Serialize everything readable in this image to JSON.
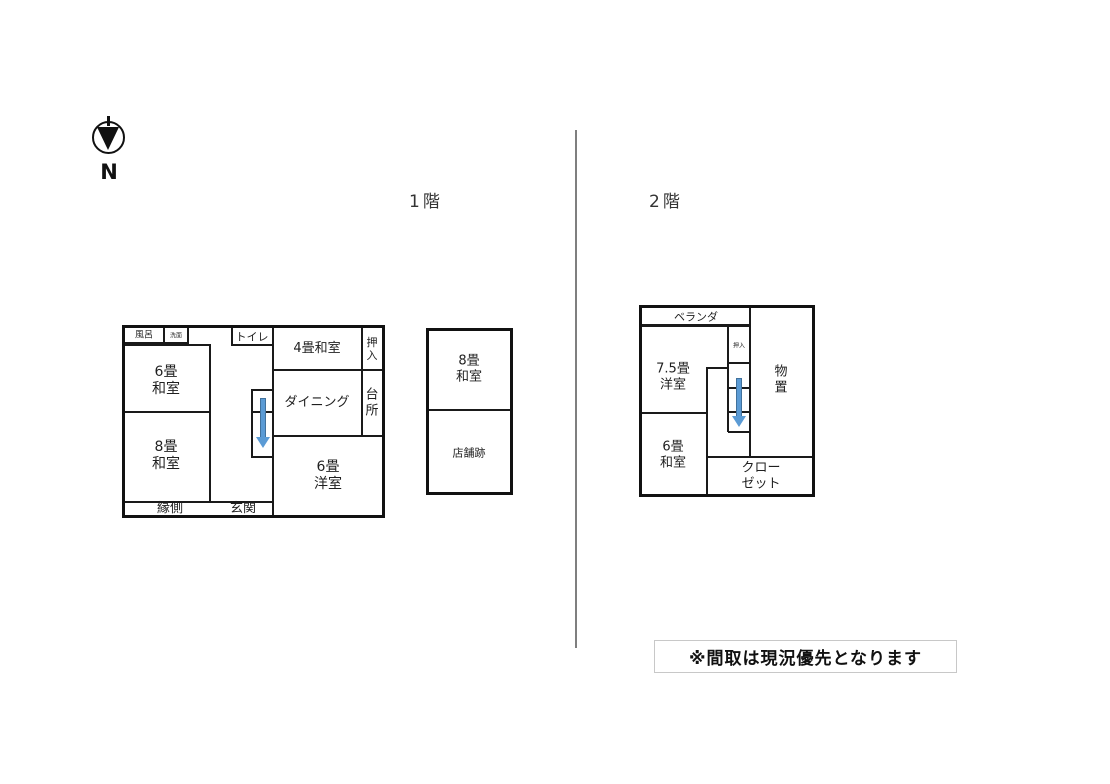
{
  "compass": {
    "label": "N"
  },
  "floors": {
    "floor1": {
      "title": "1階",
      "rooms": {
        "bath": "風呂",
        "washroom": "洗面",
        "toilet": "トイレ",
        "tatami4": "4畳和室",
        "oshiire": "押\n入",
        "tatami6": "6畳\n和室",
        "dining": "ダイニング",
        "kitchen": "台\n所",
        "tatami8": "8畳\n和室",
        "western6": "6畳\n洋室",
        "engawa": "縁側",
        "genkan": "玄関"
      }
    },
    "annex": {
      "rooms": {
        "tatami8": "8畳\n和室",
        "shop": "店舗跡"
      }
    },
    "floor2": {
      "title": "2階",
      "rooms": {
        "veranda": "ベランダ",
        "western75": "7.5畳\n洋室",
        "oshiire": "押入",
        "storage": "物\n置",
        "tatami6": "6畳\n和室",
        "closet": "クローゼット"
      }
    }
  },
  "note": "※間取は現況優先となります",
  "colors": {
    "arrow": "#5b9bd5",
    "arrow_border": "#41719c",
    "wall": "#1a1a1a",
    "divider": "#7f7f7f"
  }
}
